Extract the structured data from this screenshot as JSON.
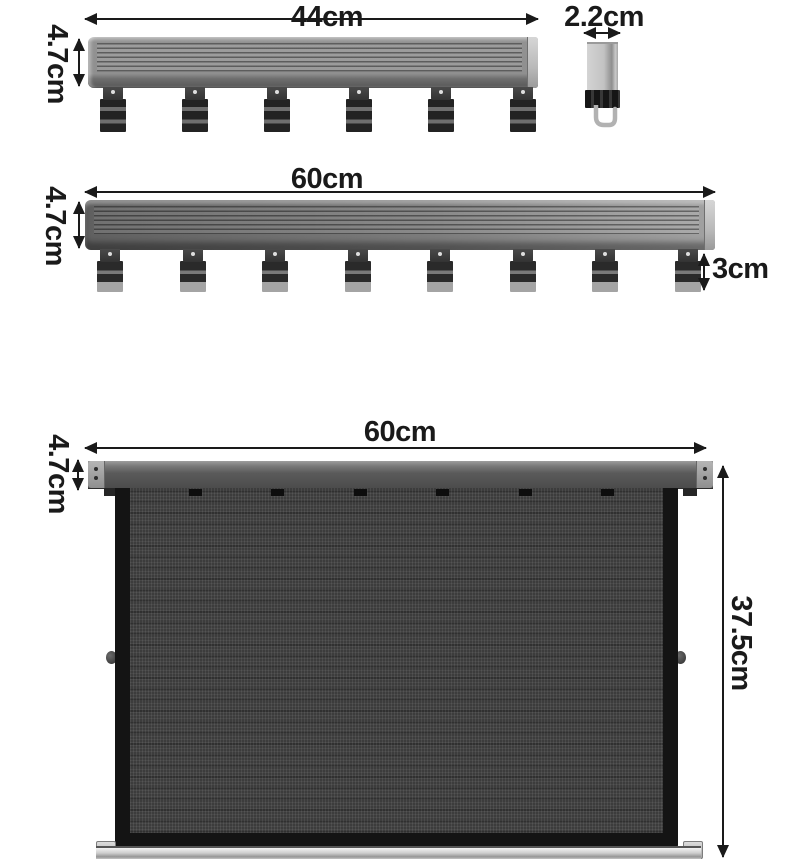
{
  "palette": {
    "background": "#ffffff",
    "annotation": "#1a1a1a",
    "rail_light_gray": "#8f8f8f",
    "rail_dark_gray": "#6a6a6a",
    "end_cap_gray": "#c4c4c4",
    "hook_dark": "#262626",
    "hook_tip_light": "#a4a4a4",
    "screen_mesh": "#3c3c3c",
    "screen_frame": "#141414",
    "header_bar": "#5a5a5a",
    "base_bar_silver": "#cfcfcf"
  },
  "figures": {
    "rail44": {
      "width_label": "44cm",
      "height_label": "4.7cm",
      "hook_count": 6
    },
    "side_view": {
      "depth_label": "2.2cm"
    },
    "rail60": {
      "width_label": "60cm",
      "height_label": "4.7cm",
      "hook_height_label": "3cm",
      "hook_count": 8
    },
    "screen": {
      "width_label": "60cm",
      "header_height_label": "4.7cm",
      "total_height_label": "37.5cm",
      "clip_count": 6
    }
  }
}
